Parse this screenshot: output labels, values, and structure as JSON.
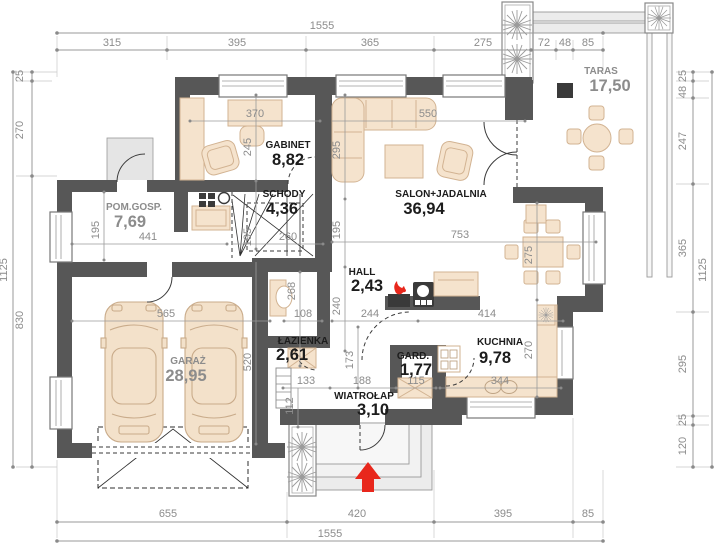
{
  "colors": {
    "wall": "#575757",
    "dimension_text": "#8c8c8c",
    "room_label": "#1c1c1c",
    "room_label_muted": "#8c8c8c",
    "furniture_fill": "#f5e3cd",
    "furniture_stroke": "#d2b392",
    "accent_red": "#e8271c",
    "deck_gray": "#ececec"
  },
  "rooms": {
    "pom_gosp": {
      "name": "POM.GOSP.",
      "area": "7,69"
    },
    "gabinet": {
      "name": "GABINET",
      "area": "8,82"
    },
    "schody": {
      "name": "SCHODY",
      "area": "4,36"
    },
    "salon": {
      "name": "SALON+JADALNIA",
      "area": "36,94"
    },
    "taras": {
      "name": "TARAS",
      "area": "17,50"
    },
    "hall": {
      "name": "HALL",
      "area": "2,43"
    },
    "lazienka": {
      "name": "ŁAZIENKA",
      "area": "2,61"
    },
    "garaz": {
      "name": "GARAŻ",
      "area": "28,95"
    },
    "kuchnia": {
      "name": "KUCHNIA",
      "area": "9,78"
    },
    "gard": {
      "name": "GARD.",
      "area": "1,77"
    },
    "wiatrolap": {
      "name": "WIATROŁAP",
      "area": "3,10"
    }
  },
  "dims": {
    "top": {
      "total": "1555",
      "segments": [
        "315",
        "395",
        "365",
        "275",
        "72",
        "48",
        "85"
      ]
    },
    "bottom": {
      "total": "1555",
      "segments": [
        "655",
        "420",
        "395",
        "85"
      ]
    },
    "left": {
      "total": "1125",
      "segments": [
        "25",
        "270",
        "830"
      ]
    },
    "right": {
      "total": "1125",
      "segments": [
        "25",
        "48",
        "247",
        "365",
        "295",
        "25",
        "120"
      ]
    },
    "interior": {
      "gabinet_w": "370",
      "gabinet_h": "245",
      "salon_w": "550",
      "salon_h": "295",
      "salon_l": "753",
      "schody_side_r": "195",
      "schody_side_l": "195",
      "schody_w": "260",
      "pomgosp_h": "195",
      "pomgosp_w": "441",
      "garaz_w": "565",
      "garaz_h": "520",
      "lazienka_h": "268",
      "lazienka_w": "108",
      "hall_h": "240",
      "hall_w": "244",
      "kuchnia_w": "414",
      "kuchnia_h": "270",
      "jadalnia_h": "275",
      "kuchnia_counter": "344",
      "gard_w": "115",
      "wiatrolap_w1": "133",
      "wiatrolap_w2": "188",
      "wiatrolap_h": "173",
      "wiatrolap_side": "112"
    }
  }
}
